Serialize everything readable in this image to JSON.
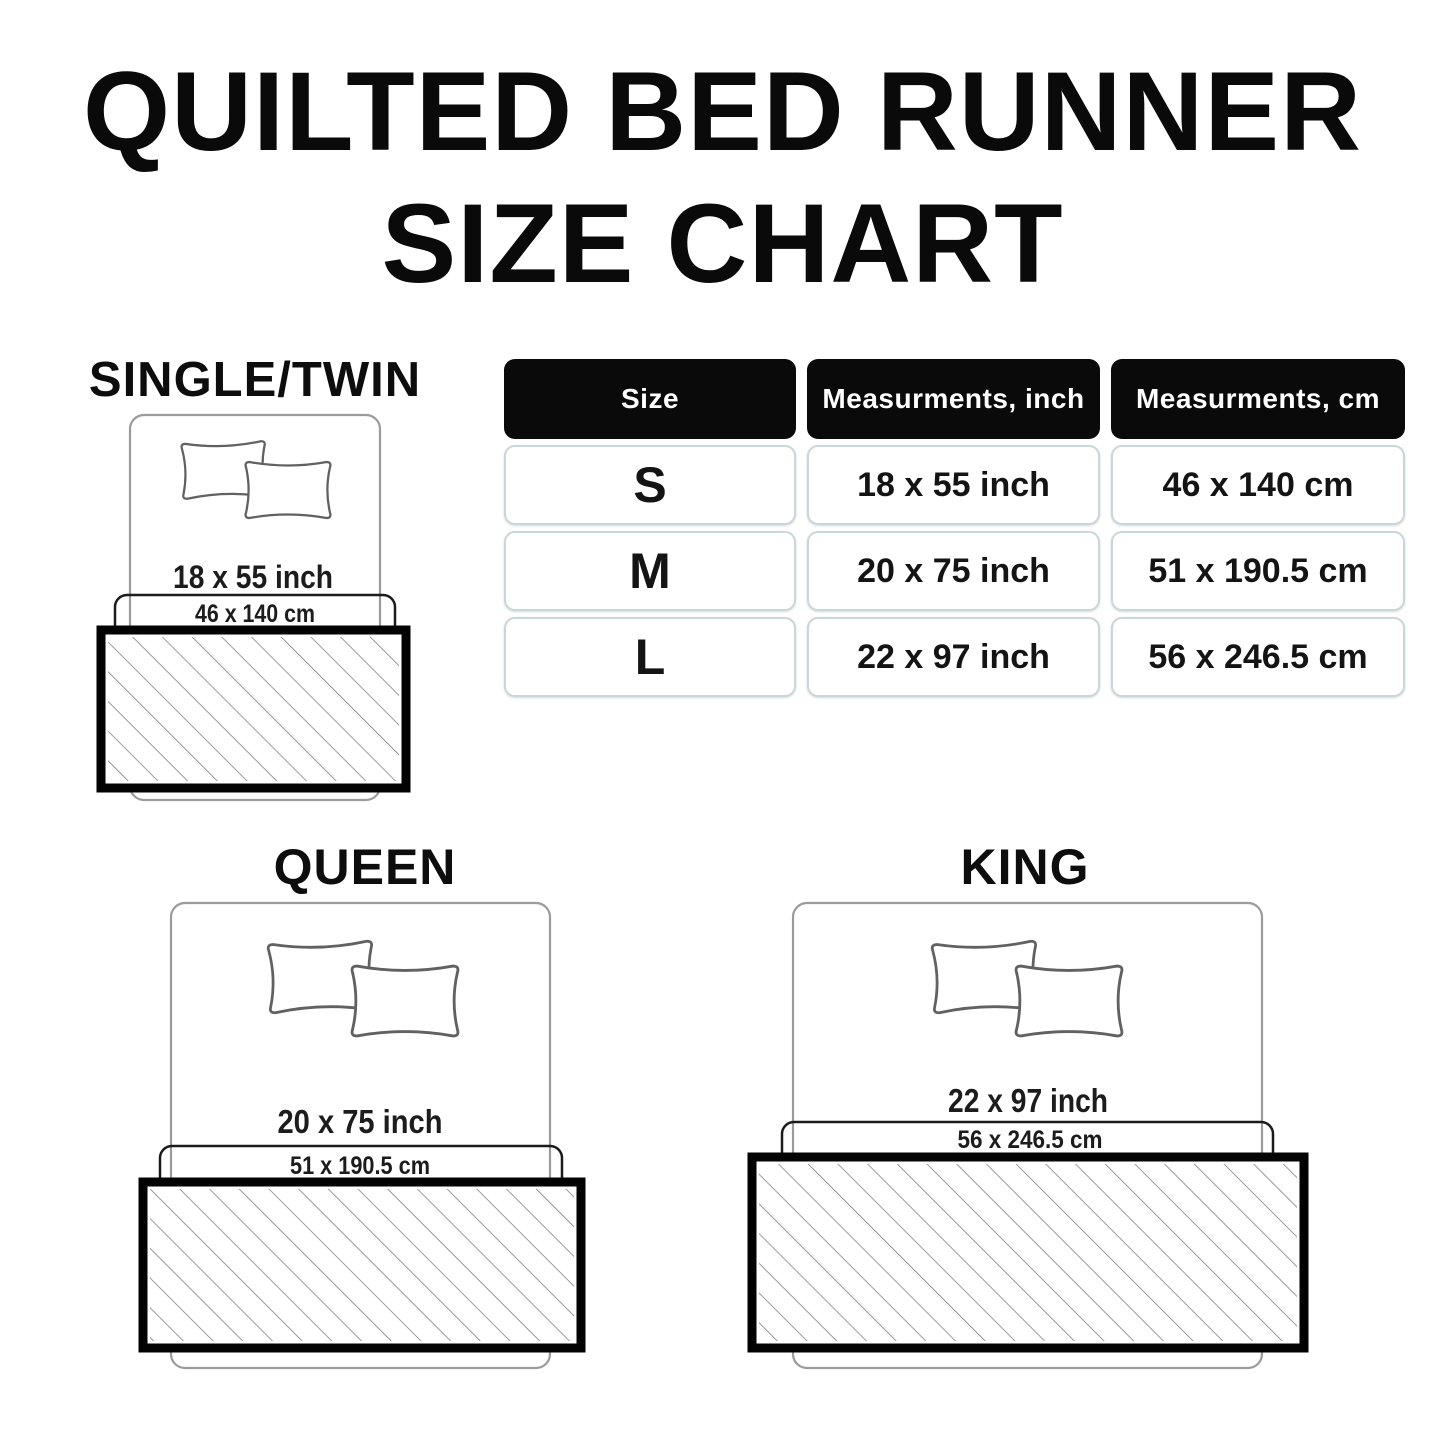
{
  "title": {
    "line1": "QUILTED BED RUNNER",
    "line2": "SIZE CHART"
  },
  "table": {
    "headers": [
      "Size",
      "Measurments, inch",
      "Measurments, cm"
    ],
    "rows": [
      {
        "size": "S",
        "inch": "18 x 55 inch",
        "cm": "46 x 140 cm"
      },
      {
        "size": "M",
        "inch": "20 x 75 inch",
        "cm": "51 x 190.5 cm"
      },
      {
        "size": "L",
        "inch": "22 x 97 inch",
        "cm": "56 x 246.5 cm"
      }
    ]
  },
  "diagrams": {
    "single_twin": {
      "label": "SINGLE/TWIN",
      "inch": "18 x 55 inch",
      "cm": "46 x 140 cm"
    },
    "queen": {
      "label": "QUEEN",
      "inch": "20 x 75 inch",
      "cm": "51 x 190.5 cm"
    },
    "king": {
      "label": "KING",
      "inch": "22 x 97 inch",
      "cm": "56 x 246.5 cm"
    }
  },
  "colors": {
    "background": "#ffffff",
    "title_text": "#0a0a0a",
    "header_bg": "#0a0a0a",
    "header_text": "#ffffff",
    "cell_border": "#c9d6da",
    "cell_text": "#141414",
    "bed_outline": "#9b9b9b",
    "pillow_outline": "#616161",
    "band_outline": "#1b1b1b",
    "runner_border": "#000000",
    "hatch_line": "#7a7a7a"
  }
}
